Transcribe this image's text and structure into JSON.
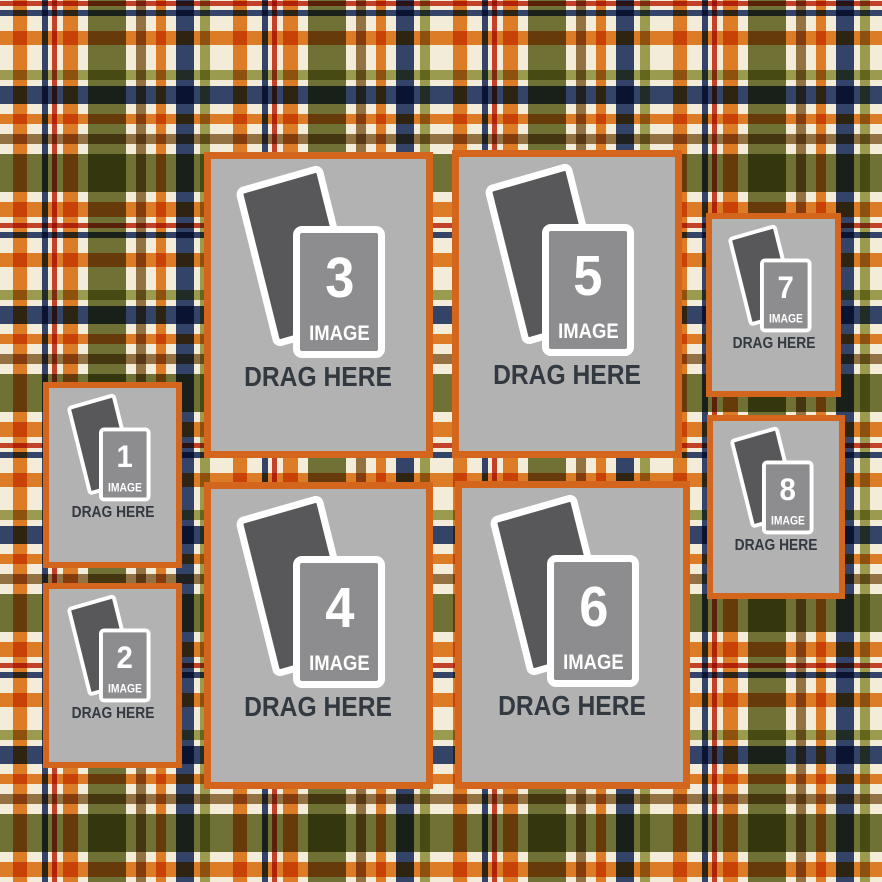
{
  "canvas": {
    "width": 882,
    "height": 882,
    "description": "photo collage template with plaid background and numbered drag-and-drop image placeholders"
  },
  "placeholder": {
    "image_label": "IMAGE",
    "drag_label": "DRAG HERE"
  },
  "colors": {
    "frame_orange": "#d4651d",
    "placeholder_gray": "#b3b2b3",
    "photo_back_gray": "#58585a",
    "photo_front_gray": "#8d8d8f",
    "icon_white": "#ffffff",
    "drag_text": "#333940",
    "plaid_cream": "#f2ecd9",
    "plaid_orange": "#e8862d",
    "plaid_olive": "#767a3e",
    "plaid_light_green": "#a3a75d",
    "plaid_navy": "#36497a",
    "plaid_red": "#cb4730",
    "plaid_tan": "#9a7b4e"
  },
  "zones": [
    {
      "number": "1",
      "x": 43,
      "y": 382,
      "w": 139,
      "h": 186,
      "size": "small"
    },
    {
      "number": "2",
      "x": 43,
      "y": 583,
      "w": 139,
      "h": 185,
      "size": "small"
    },
    {
      "number": "3",
      "x": 204,
      "y": 152,
      "w": 229,
      "h": 306,
      "size": "large"
    },
    {
      "number": "4",
      "x": 204,
      "y": 482,
      "w": 229,
      "h": 307,
      "size": "large"
    },
    {
      "number": "5",
      "x": 452,
      "y": 150,
      "w": 230,
      "h": 308,
      "size": "large"
    },
    {
      "number": "6",
      "x": 455,
      "y": 481,
      "w": 235,
      "h": 308,
      "size": "large"
    },
    {
      "number": "7",
      "x": 706,
      "y": 213,
      "w": 135,
      "h": 184,
      "size": "small"
    },
    {
      "number": "8",
      "x": 707,
      "y": 415,
      "w": 138,
      "h": 184,
      "size": "small"
    }
  ]
}
